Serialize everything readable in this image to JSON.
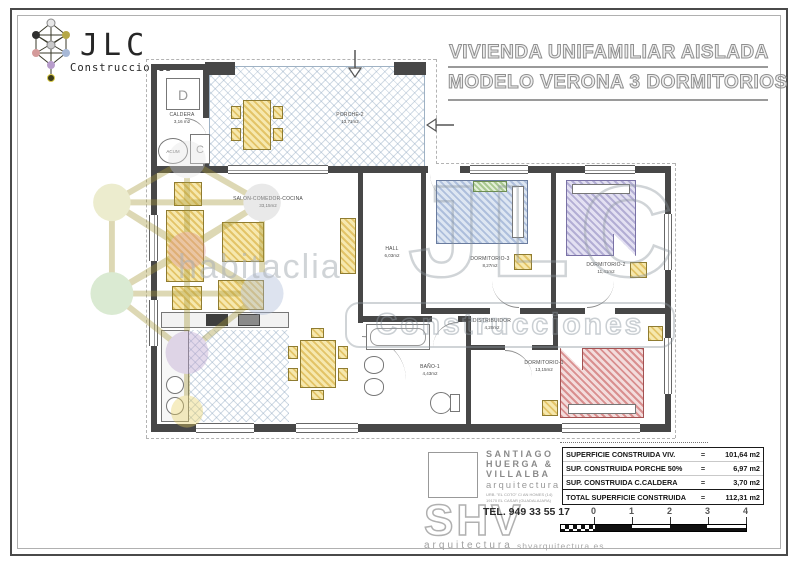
{
  "logo": {
    "company": "JLC",
    "subtitle": "Construcciones"
  },
  "title_block": {
    "line1": "VIVIENDA UNIFAMILIAR AISLADA",
    "line2": "MODELO VERONA 3 DORMITORIOS"
  },
  "plan": {
    "rooms": [
      {
        "id": "caldera",
        "name": "CALDERA",
        "area": "3,16 m2"
      },
      {
        "id": "porche",
        "name": "PORCHE-2",
        "area": "13,71m2"
      },
      {
        "id": "salon",
        "name": "SALON-COMEDOR-COCINA",
        "area": "33,15m2"
      },
      {
        "id": "hall",
        "name": "HALL",
        "area": "6,03m2"
      },
      {
        "id": "dormitorio3",
        "name": "DORMITORIO-3",
        "area": "8,27m2"
      },
      {
        "id": "dormitorio2",
        "name": "DORMITORIO-2",
        "area": "11,41m2"
      },
      {
        "id": "distribuidor",
        "name": "DISTRIBUIDOR",
        "area": "4,20m2"
      },
      {
        "id": "bano1",
        "name": "BAÑO-1",
        "area": "4,43m2"
      },
      {
        "id": "dormitorio1",
        "name": "DORMITORIO-1",
        "area": "13,15m2"
      }
    ],
    "caldera_marks": {
      "d_unit": "D",
      "accumulator": "ACUM",
      "c_unit": "C"
    }
  },
  "watermarks": {
    "brand_big": "JLC",
    "brand_box": "Construcciones",
    "portal": "habitaclia",
    "studio_logo": "SHV",
    "studio_caption": "arquitectura",
    "studio_site": "shvarquitectura.es"
  },
  "architect": {
    "name_line1": "SANTIAGO",
    "name_line2": "HUERGA  &",
    "name_line3": "VILLALBA",
    "profession": "arquitectura",
    "address_line1": "URB. \"EL COTO\"  C/ AN HOMES (14)",
    "address_line2": "19170  EL CASAR  (GUADALAJARA)",
    "phone": "TEL.  949 33 55 17"
  },
  "areas_table": {
    "rows": [
      {
        "label": "SUPERFICIE CONSTRUIDA VIV.",
        "eq": "=",
        "value": "101,64 m2"
      },
      {
        "label": "SUP. CONSTRUIDA PORCHE 50%",
        "eq": "=",
        "value": "6,97 m2"
      },
      {
        "label": "SUP. CONSTRUIDA C.CALDERA",
        "eq": "=",
        "value": "3,70 m2"
      }
    ],
    "total": {
      "label": "TOTAL SUPERFICIE CONSTRUIDA",
      "eq": "=",
      "value": "112,31 m2"
    }
  },
  "scale_bar": {
    "ticks": [
      "0",
      "1",
      "2",
      "3",
      "4"
    ]
  }
}
